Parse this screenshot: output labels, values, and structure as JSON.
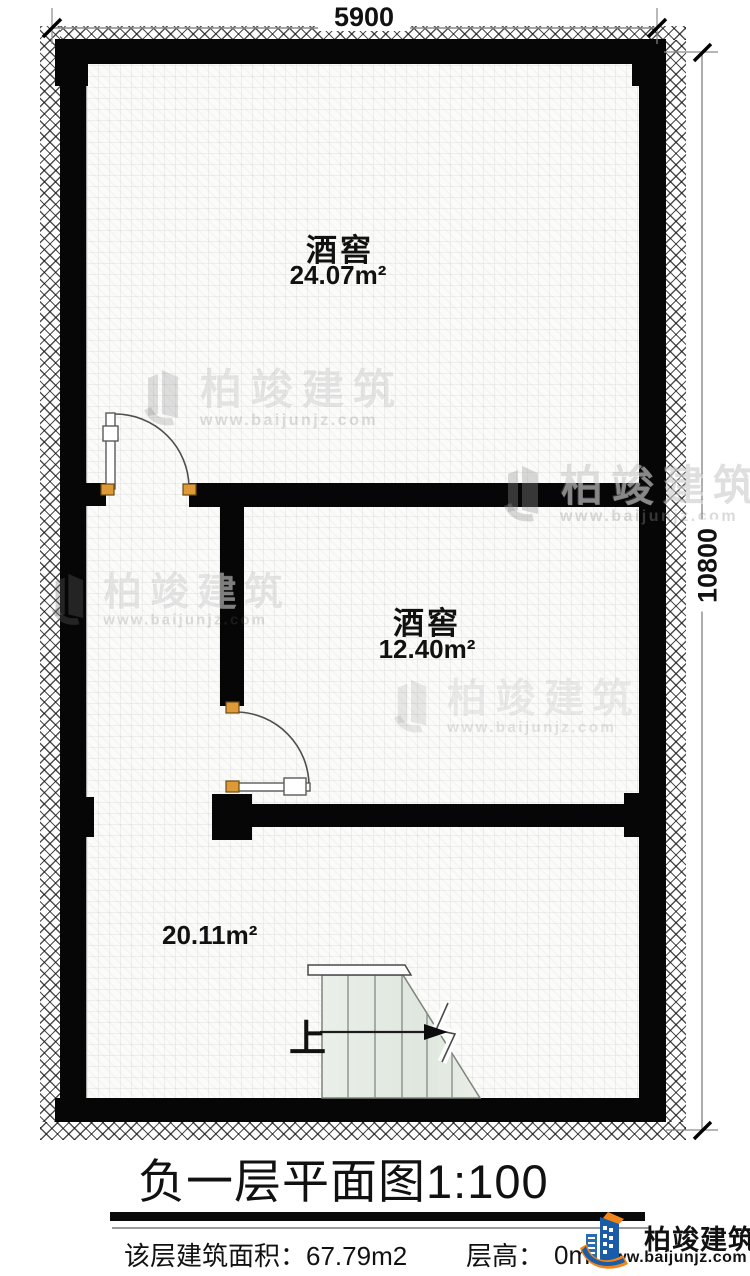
{
  "dimensions": {
    "top": "5900",
    "right": "10800"
  },
  "rooms": [
    {
      "name": "酒窖",
      "area": "24.07m²"
    },
    {
      "name": "酒窖",
      "area": "12.40m²"
    },
    {
      "name": "",
      "area": "20.11m²"
    }
  ],
  "stairs": {
    "up_label": "上"
  },
  "title": {
    "text": "负一层平面图",
    "scale": "1:100"
  },
  "footer": {
    "area_label": "该层建筑面积：",
    "area_value": "67.79m2",
    "height_label": "层高：",
    "height_value_visible": "0m"
  },
  "watermark": {
    "brand": "柏竣建筑",
    "url": "www.baijunjz.com"
  },
  "logo": {
    "brand": "柏竣建筑",
    "url": "www.baijunjz.com",
    "blue": "#1b5ca8",
    "orange": "#f0861a"
  },
  "colors": {
    "wall": "#060606",
    "hinge": "#dd9a36",
    "stair_fill": "#e4ebe3"
  }
}
